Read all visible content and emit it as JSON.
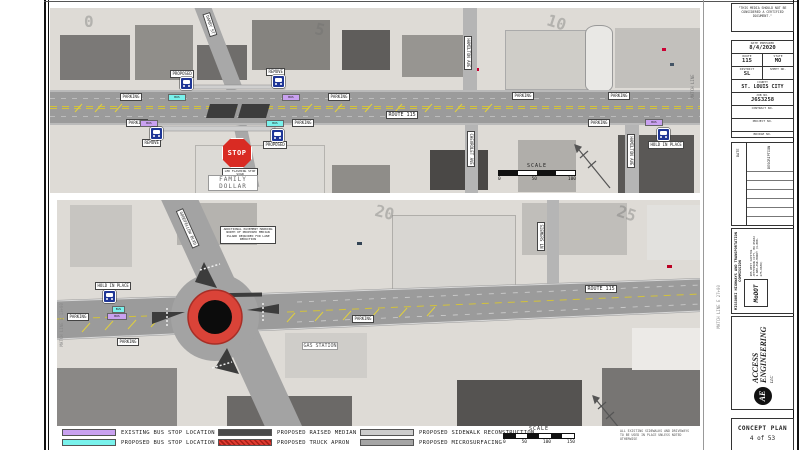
{
  "labels": {
    "parking": "PARKING",
    "bus": "BUS"
  },
  "top_plan": {
    "route_label": "ROUTE 115",
    "streets": {
      "darby": "DARBY ST",
      "hamilton_n": "HAMILTON AVE",
      "chevrolet": "CHEVROLET AVE",
      "hamilton_s": "HAMILTON AVE"
    },
    "match_line": "MATCH LINE",
    "stations": [
      "0",
      "5",
      "10"
    ],
    "stop_sign": "STOP",
    "stop_note": "LED FLASHING STOP SIGN",
    "store": "FAMILY DOLLAR",
    "bus_notes": {
      "proposed": "PROPOSED",
      "remove": "REMOVE",
      "hold": "HOLD IN PLACE"
    }
  },
  "bottom_plan": {
    "route_label": "ROUTE 115",
    "streets": {
      "goodfellow": "GOODFELLOW BLVD",
      "siemers": "SIEMERS LN"
    },
    "gas_station": "GAS STATION",
    "match_line_left": "MATCH LINE E 13+00",
    "match_line_right": "MATCH LINE E 27+00",
    "stations": [
      "20",
      "25"
    ],
    "marking_note": "ADDITIONAL PAVEMENT MARKING NORTH OF PROPOSED MEDIAN ISLAND REQUIRED FOR LANE REDUCTION",
    "bus_note": "HOLD IN PLACE"
  },
  "legend": {
    "items": [
      {
        "label": "EXISTING BUS STOP LOCATION",
        "color": "#c9a1f0"
      },
      {
        "label": "PROPOSED BUS STOP LOCATION",
        "color": "#79f2ec"
      },
      {
        "label": "PROPOSED RAISED MEDIAN",
        "color": "#4a4a4a"
      },
      {
        "label": "PROPOSED TRUCK APRON",
        "color": "#e03a30"
      },
      {
        "label": "PROPOSED SIDEWALK RECONSTRUCTION",
        "color": "#cdcdcd"
      },
      {
        "label": "PROPOSED MICROSURFACING",
        "color": "#a5a5a5"
      }
    ]
  },
  "scales": {
    "top": {
      "title": "SCALE",
      "ticks": [
        "0",
        "50",
        "100"
      ]
    },
    "bottom": {
      "title": "SCALE",
      "ticks": [
        "0",
        "50",
        "100",
        "150"
      ]
    }
  },
  "notes": {
    "sidewalks": "ALL EXISTING SIDEWALKS AND DRIVEWAYS TO BE USED IN PLACE UNLESS NOTED OTHERWISE"
  },
  "title_block": {
    "disclaimer": "\"THIS MEDIA SHOULD NOT BE CONSIDERED A CERTIFIED DOCUMENT.\"",
    "fields": [
      {
        "label": "DATE PREPARED",
        "value": "8/4/2020"
      },
      {
        "label": "ROUTE",
        "value": "115"
      },
      {
        "label": "STATE",
        "value": "MO"
      },
      {
        "label": "DISTRICT",
        "value": "SL"
      },
      {
        "label": "SHEET NO.",
        "value": ""
      },
      {
        "label": "COUNTY",
        "value": "ST. LOUIS CITY"
      },
      {
        "label": "JOB NO.",
        "value": "J6S3258"
      },
      {
        "label": "CONTRACT NO.",
        "value": ""
      },
      {
        "label": "PROJECT NO.",
        "value": ""
      },
      {
        "label": "BRIDGE NO.",
        "value": ""
      }
    ],
    "revisions": {
      "date": "DATE",
      "description": "DESCRIPTION"
    },
    "agency": "MISSOURI HIGHWAYS AND TRANSPORTATION COMMISSION",
    "modot_name": "MoDOT",
    "modot_address": "105 WEST CAPITOL  JEFFERSON CITY, MO 65102  1-888-ASK-MODOT (1-888-275-6636)",
    "firm_initials": "AE",
    "firm_name": "ACCESS ENGINEERING",
    "firm_suffix": "LLC",
    "sheet_title": "CONCEPT PLAN",
    "sheet_number": "4 of 53"
  }
}
